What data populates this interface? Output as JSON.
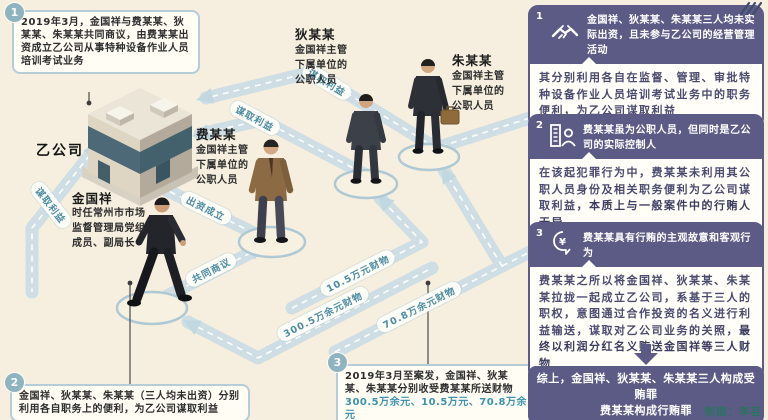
{
  "colors": {
    "background": "#f6efdf",
    "panel_purple": "#5c5b86",
    "badge_teal": "#8fb4c0",
    "road": "#cfdee4",
    "road_label_blue": "#4e8ca3",
    "amount_blue": "#3d93ad",
    "credit_green": "#2c7263"
  },
  "company": {
    "label": "乙公司"
  },
  "people": {
    "jin": {
      "name": "金国祥",
      "desc": "时任常州市市场监督管理局党组成员、副局长"
    },
    "fei": {
      "name": "费某某",
      "desc": "金国祥主管下属单位的公职人员"
    },
    "di": {
      "name": "狄某某",
      "desc": "金国祥主管下属单位的公职人员"
    },
    "zhu": {
      "name": "朱某某",
      "desc": "金国祥主管下属单位的公职人员"
    }
  },
  "roads": {
    "benefit": "谋取利益",
    "found": "出资成立",
    "discuss": "共同商议",
    "money_jin": "300.5万余元财物",
    "money_di": "10.5万元财物",
    "money_zhu": "70.8万余元财物"
  },
  "callouts": {
    "c1": {
      "num": "1",
      "text": "2019年3月，金国祥与费某某、狄某某、朱某某共同商议，由费某某出资成立乙公司从事特种设备作业人员培训考试业务"
    },
    "c2": {
      "num": "2",
      "text": "金国祥、狄某某、朱某某（三人均未出资）分别利用各自职务上的便利，为乙公司谋取利益"
    },
    "c3": {
      "num": "3",
      "text_pre": "2019年3月至案发，金国祥、狄某某、朱某某分别收受费某某所送财物",
      "amounts": "300.5万余元、10.5万元、70.8万余元"
    }
  },
  "panel": {
    "boxes": [
      {
        "num": "1",
        "icon": "handshake-icon",
        "header": "金国祥、狄某某、朱某某三人均未实际出资，且未参与乙公司的经营管理活动",
        "body_pre": "其分别利用各自在监督、管理、审批特种设备作业人员培训考试业务中的职务便利，为乙公司谋取利益",
        "body_bold": ""
      },
      {
        "num": "2",
        "icon": "company-controller-icon",
        "header": "费某某虽为公职人员，但同时是乙公司的实际控制人",
        "body_pre": "在该起犯罪行为中，费某某未利用其公职人员身份及相关职务便利为乙公司谋取利益，",
        "body_bold": "本质上与一般案件中的行贿人无异"
      },
      {
        "num": "3",
        "icon": "bribe-intent-icon",
        "header": "费某某具有行贿的主观故意和客观行为",
        "body_pre": "费某某之所以将金国祥、狄某某、朱某某拉拢一起成立乙公司，系基于三人的职权，意图通过合作投资的名义进行利益输送，谋取对乙公司业务的关照，",
        "body_bold": "最终以利润分红名义贿送金国祥等三人财物"
      }
    ],
    "summary_line1": "综上，金国祥、狄某某、朱某某三人构成受贿罪",
    "summary_line2": "费某某构成行贿罪",
    "credit": "制图：李芸"
  }
}
